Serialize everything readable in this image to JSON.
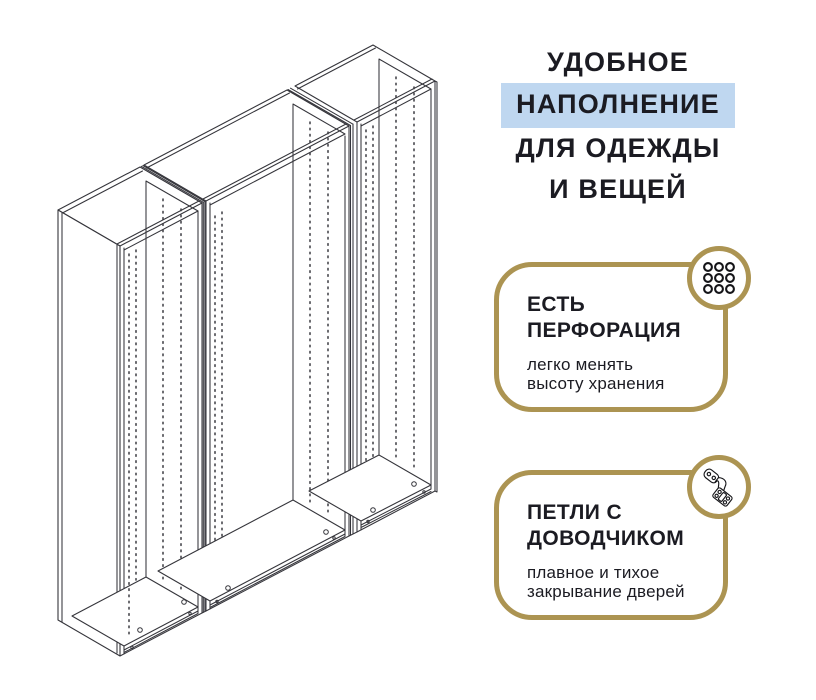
{
  "page": {
    "background": "#ffffff"
  },
  "headline": {
    "lines": [
      "УДОБНОЕ",
      "НАПОЛНЕНИЕ",
      "ДЛЯ ОДЕЖДЫ",
      "И ВЕЩЕЙ"
    ],
    "highlighted_line_index": 1,
    "highlight_color": "#bfd7f0",
    "text_color": "#1b1b22"
  },
  "features": [
    {
      "icon": "perforation-holes-icon",
      "title_lines": [
        "ЕСТЬ",
        "ПЕРФОРАЦИЯ"
      ],
      "desc_lines": [
        "легко менять",
        "высоту хранения"
      ]
    },
    {
      "icon": "soft-close-hinge-icon",
      "title_lines": [
        "ПЕТЛИ С",
        "ДОВОДЧИКОМ"
      ],
      "desc_lines": [
        "плавное и тихое",
        "закрывание дверей"
      ]
    }
  ],
  "illustration": {
    "name": "wardrobe-frame-line-drawing",
    "sections": 3
  },
  "colors": {
    "accent_gold": "#ac9452",
    "line_color": "#35353b",
    "highlight_blue": "#bfd7f0",
    "text": "#1b1b22"
  }
}
